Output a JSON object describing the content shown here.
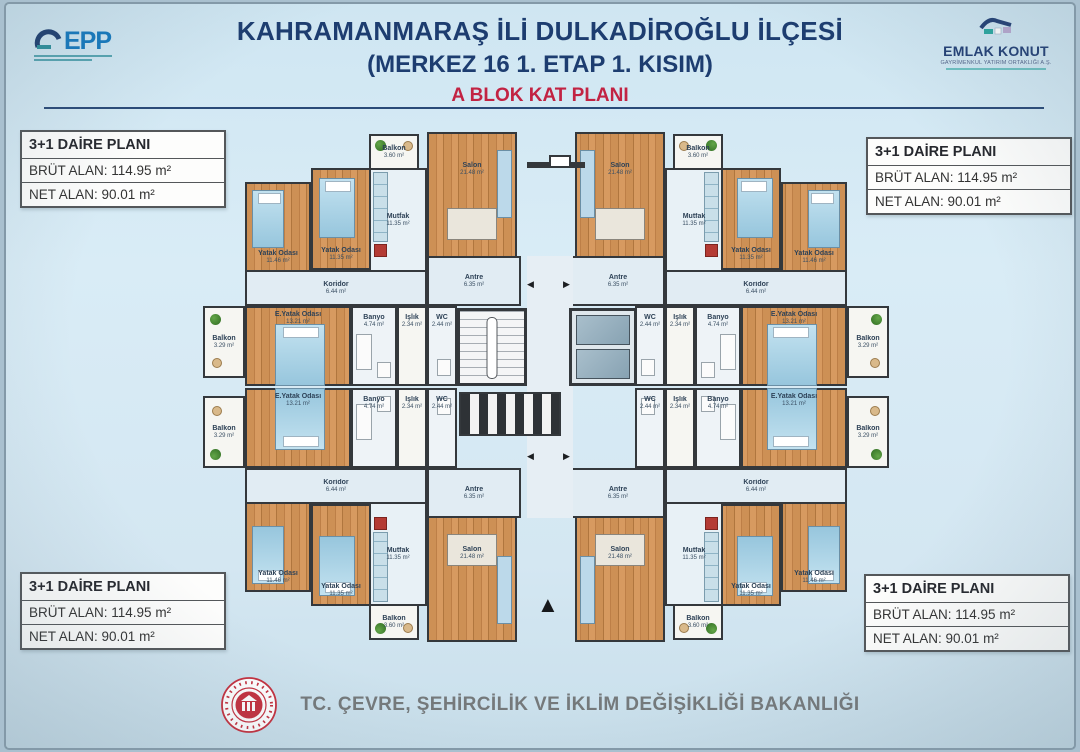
{
  "header": {
    "line1": "KAHRAMANMARAŞ İLİ DULKADİROĞLU İLÇESİ",
    "line2": "(MERKEZ 16 1. ETAP 1. KISIM)",
    "subtitle": "A BLOK KAT PLANI"
  },
  "logos": {
    "epp": {
      "text": "EPP"
    },
    "emlak": {
      "name": "EMLAK KONUT",
      "subtext": "GAYRİMENKUL YATIRIM ORTAKLIĞI A.Ş."
    }
  },
  "info_box": {
    "title": "3+1 DAİRE PLANI",
    "brut": "BRÜT ALAN: 114.95 m²",
    "net": "NET ALAN: 90.01 m²"
  },
  "rooms": {
    "salon": {
      "name": "Salon",
      "area": "21.48 m²"
    },
    "mutfak": {
      "name": "Mutfak",
      "area": "11.35 m²"
    },
    "balkon_ust": {
      "name": "Balkon",
      "area": "3.60 m²"
    },
    "yatak1": {
      "name": "Yatak Odası",
      "area": "11.46 m²"
    },
    "yatak2": {
      "name": "Yatak Odası",
      "area": "11.35 m²"
    },
    "ebeveyn": {
      "name": "E.Yatak Odası",
      "area": "13.21 m²"
    },
    "balkon_yan": {
      "name": "Balkon",
      "area": "3.29 m²"
    },
    "banyo": {
      "name": "Banyo",
      "area": "4.74 m²"
    },
    "islik": {
      "name": "Işlık",
      "area": "2.34 m²"
    },
    "wc": {
      "name": "WC",
      "area": "2.44 m²"
    },
    "koridor": {
      "name": "Koridor",
      "area": "6.44 m²"
    },
    "antre": {
      "name": "Antre",
      "area": "6.35 m²"
    }
  },
  "plan": {
    "north_arrow": "▲",
    "door_arrow_left": "◀",
    "door_arrow_right": "▶"
  },
  "footer": {
    "ministry": "TC. ÇEVRE, ŞEHİRCİLİK VE İKLİM DEĞİŞİKLİĞİ BAKANLIĞI"
  },
  "colors": {
    "title": "#1d3d70",
    "subtitle": "#c22343",
    "wall": "#34383c",
    "wood": "#c98e58",
    "seal_red": "#c5303e"
  }
}
